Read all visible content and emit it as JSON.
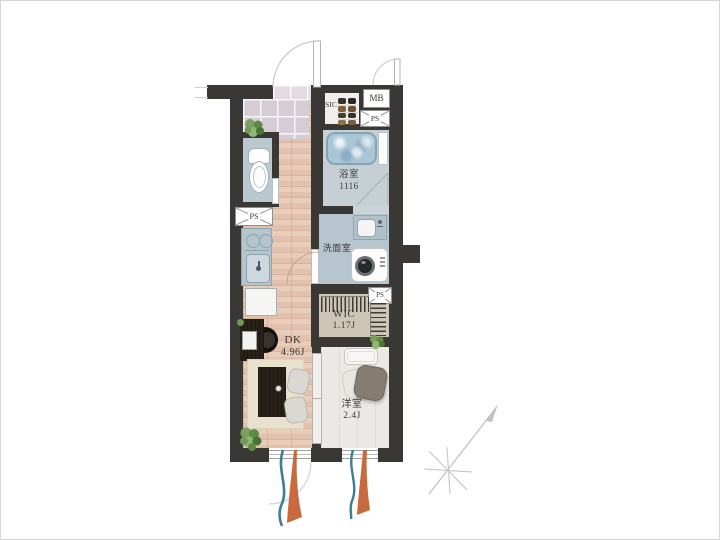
{
  "plan": {
    "rooms": {
      "sic": {
        "name": "SIC"
      },
      "mb": {
        "name": "MB"
      },
      "ps_top": {
        "name": "PS"
      },
      "ps_left": {
        "name": "PS"
      },
      "ps_mid": {
        "name": "PS"
      },
      "bathroom": {
        "name": "浴室",
        "size": "1116"
      },
      "washroom": {
        "name": "洗面室"
      },
      "wic": {
        "name": "WIC",
        "size": "1.17J"
      },
      "dk": {
        "name": "DK",
        "size": "4.96J"
      },
      "bedroom": {
        "name": "洋室",
        "size": "2.4J"
      }
    },
    "colors": {
      "wall": "#3a3835",
      "wood_floor": "#e2c2ae",
      "entrance_tile": "#d6ccd6",
      "wet_area_floor": "#b7c6ce",
      "bathroom_floor": "#c6d0d4",
      "bath_water": "#a9c6d6",
      "wic_floor": "#cdc6b7",
      "bedroom_floor": "#ebe9e5",
      "rug": "#e7e1cd",
      "curtain_blue": "#3e7e95",
      "curtain_orange": "#c76a3e",
      "plant_green": "#6f9b57"
    }
  }
}
